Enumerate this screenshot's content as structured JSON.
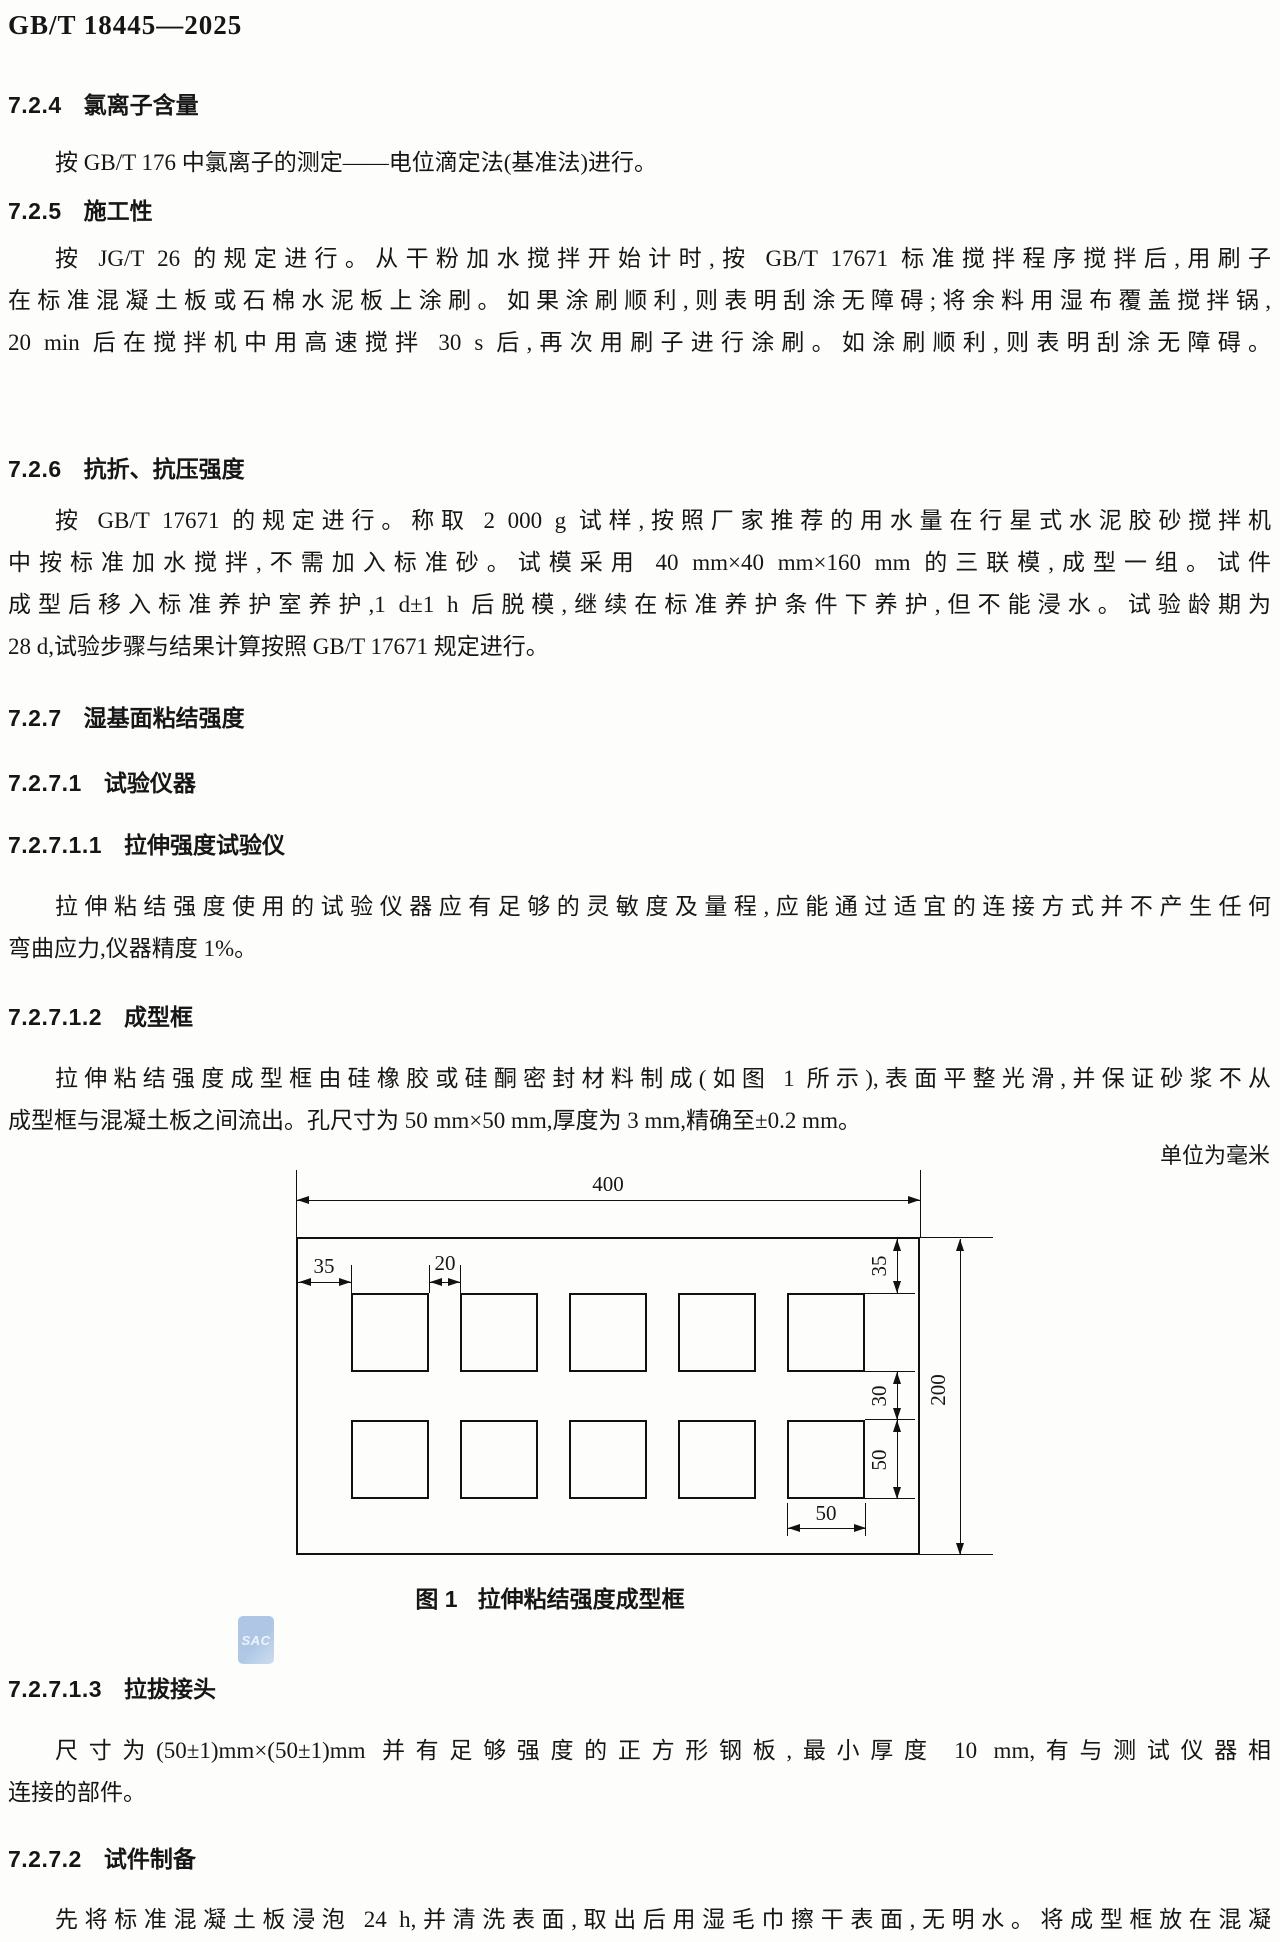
{
  "page": {
    "standard_code": "GB/T 18445—2025",
    "unit_note": "单位为毫米",
    "watermark": "SAC"
  },
  "sections": {
    "h724": {
      "num": "7.2.4",
      "title": "氯离子含量"
    },
    "p724": {
      "lines": [
        "按 GB/T 176 中氯离子的测定——电位滴定法(基准法)进行。"
      ]
    },
    "h725": {
      "num": "7.2.5",
      "title": "施工性"
    },
    "p725": {
      "lines": [
        "按 JG/T 26 的规定进行。从干粉加水搅拌开始计时,按 GB/T 17671 标准搅拌程序搅拌后,用刷子",
        "在标准混凝土板或石棉水泥板上涂刷。如果涂刷顺利,则表明刮涂无障碍;将余料用湿布覆盖搅拌锅,",
        "20 min 后在搅拌机中用高速搅拌 30 s 后,再次用刷子进行涂刷。如涂刷顺利,则表明刮涂无障碍。"
      ]
    },
    "h726": {
      "num": "7.2.6",
      "title": "抗折、抗压强度"
    },
    "p726": {
      "lines": [
        "按 GB/T 17671 的规定进行。称取 2 000 g 试样,按照厂家推荐的用水量在行星式水泥胶砂搅拌机",
        "中按标准加水搅拌,不需加入标准砂。试模采用 40 mm×40 mm×160 mm 的三联模,成型一组。试件",
        "成型后移入标准养护室养护,1 d±1 h 后脱模,继续在标准养护条件下养护,但不能浸水。试验龄期为",
        "28 d,试验步骤与结果计算按照 GB/T 17671 规定进行。"
      ]
    },
    "h727": {
      "num": "7.2.7",
      "title": "湿基面粘结强度"
    },
    "h7271": {
      "num": "7.2.7.1",
      "title": "试验仪器"
    },
    "h72711": {
      "num": "7.2.7.1.1",
      "title": "拉伸强度试验仪"
    },
    "p72711": {
      "lines": [
        "拉伸粘结强度使用的试验仪器应有足够的灵敏度及量程,应能通过适宜的连接方式并不产生任何",
        "弯曲应力,仪器精度 1%。"
      ]
    },
    "h72712": {
      "num": "7.2.7.1.2",
      "title": "成型框"
    },
    "p72712": {
      "lines": [
        "拉伸粘结强度成型框由硅橡胶或硅酮密封材料制成(如图 1 所示),表面平整光滑,并保证砂浆不从",
        "成型框与混凝土板之间流出。孔尺寸为 50 mm×50 mm,厚度为 3 mm,精确至±0.2 mm。"
      ]
    },
    "h72713": {
      "num": "7.2.7.1.3",
      "title": "拉拔接头"
    },
    "p72713": {
      "lines": [
        "尺寸为(50±1)mm×(50±1)mm 并有足够强度的正方形钢板,最小厚度 10 mm,有与测试仪器相",
        "连接的部件。"
      ]
    },
    "h7272": {
      "num": "7.2.7.2",
      "title": "试件制备"
    },
    "p7272": {
      "lines": [
        "先将标准混凝土板浸泡 24 h,并清洗表面,取出后用湿毛巾擦干表面,无明水。将成型框放在混凝"
      ]
    }
  },
  "figure": {
    "caption_num": "图 1",
    "caption_title": "拉伸粘结强度成型框",
    "dims": {
      "total_width": "400",
      "left_margin": "35",
      "hole_gap": "20",
      "top_margin": "35",
      "row_gap": "30",
      "hole_height": "50",
      "hole_width": "50",
      "total_height": "200"
    }
  }
}
